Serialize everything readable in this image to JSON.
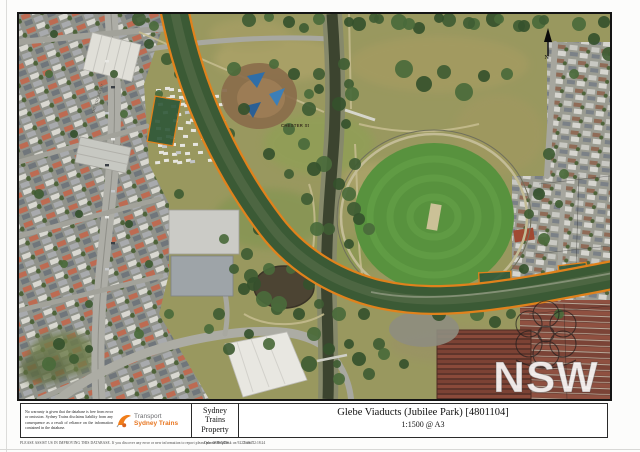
{
  "map": {
    "labels": {
      "chester_st": "CHESTER St",
      "the_crescent": "THE CRESCENT",
      "north": "N"
    },
    "colors": {
      "corridor_fill": "#2d5737",
      "corridor_outline": "#e0821c",
      "canal_water": "#3c442f",
      "oval_green": "#58923e",
      "park_olive": "#99985f"
    }
  },
  "title_block": {
    "disclaimer": "No warranty is given that the database is free from error or omission. Sydney Trains disclaims liability from any consequence as a result of reliance on the information contained in the database.",
    "logo": {
      "line1": "Transport",
      "line2": "Sydney Trains"
    },
    "department_lines": [
      "Sydney",
      "Trains",
      "Property"
    ],
    "title": "Glebe Viaducts (Jubilee Park) [4801104]",
    "scale": "1:1500 @ A3"
  },
  "footer": {
    "note": "PLEASE ASSIST US IN IMPROVING THIS DATABASE. If you discover any error or new information to report please phone HelpDesk on 9222 1947",
    "date": "Date: 08/06/2016",
    "time": "Time: 12:18:24"
  },
  "watermark": {
    "text": "NSW"
  }
}
